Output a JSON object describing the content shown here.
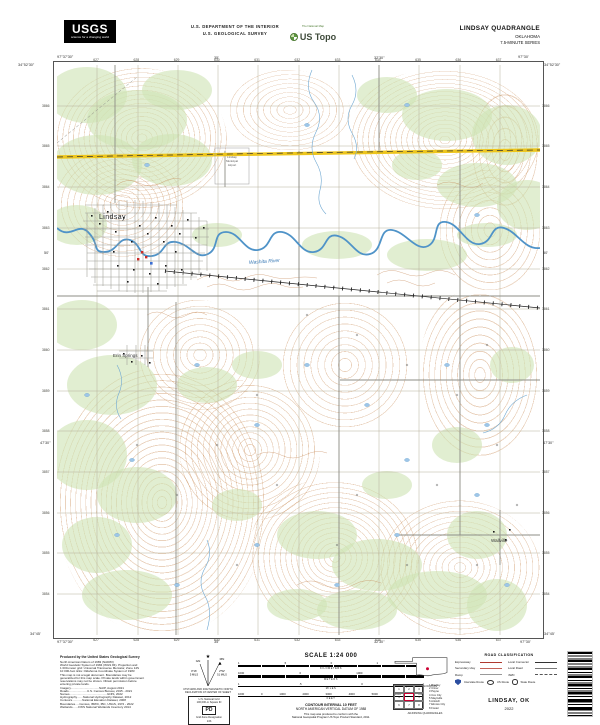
{
  "header": {
    "usgs_word": "USGS",
    "usgs_tagline": "science for a changing world",
    "dept_line1": "U.S. DEPARTMENT OF THE INTERIOR",
    "dept_line2": "U.S. GEOLOGICAL SURVEY",
    "tnm_tagline": "The National Map",
    "ustopo_name": "US Topo",
    "quad_title": "LINDSAY QUADRANGLE",
    "state": "OKLAHOMA",
    "series": "7.5-MINUTE SERIES"
  },
  "map": {
    "labels": {
      "town": "Lindsay",
      "village": "Erin Springs",
      "hamlet": "Wallville",
      "river": "Washita River",
      "airport1": "Lindsay",
      "airport2": "Municipal",
      "airport3": "Airport"
    },
    "corners": {
      "tl_lon": "97°37'30\"",
      "tl_lat": "34°52'30\"",
      "tr_lon": "97°30'",
      "tr_lat": "34°52'30\"",
      "bl_lon": "97°37'30\"",
      "bl_lat": "34°45'",
      "br_lon": "97°30'",
      "br_lat": "34°45'"
    },
    "graticule": {
      "top_a": "35'",
      "top_b": "32'30\"",
      "bottom_a": "35'",
      "bottom_b": "32'30\"",
      "left_a": "50'",
      "left_b": "47'30\"",
      "right_a": "50'",
      "right_b": "47'30\""
    },
    "top_ticks": [
      "627",
      "628",
      "629",
      "630",
      "631",
      "632",
      "633",
      "634",
      "635",
      "636",
      "637"
    ],
    "bottom_ticks": [
      "627",
      "628",
      "629",
      "630",
      "631",
      "632",
      "633",
      "634",
      "635",
      "636",
      "637"
    ],
    "left_ticks": [
      "3866",
      "3865",
      "3864",
      "3863",
      "3862",
      "3861",
      "3860",
      "3859",
      "3858",
      "3857",
      "3856",
      "3855",
      "3854"
    ],
    "right_ticks": [
      "3866",
      "3865",
      "3864",
      "3863",
      "3862",
      "3861",
      "3860",
      "3859",
      "3858",
      "3857",
      "3856",
      "3855",
      "3854"
    ],
    "colors": {
      "woods": "#cfe3b4",
      "contour": "#c07a45",
      "water": "#4f93c8",
      "highway": "#edc51c",
      "paper": "#fdfcf1",
      "building_red": "#cc2b27",
      "building_blue": "#3b6fd4"
    }
  },
  "footer": {
    "credits_title": "Produced by the United States Geological Survey",
    "credits_lines": [
      "North American Datum of 1983 (NAD83)",
      "World Geodetic System of 1984 (WGS 84). Projection and",
      "1 000-meter grid: Universal Transverse Mercator, Zone 14S",
      "10 000-foot ticks: Oklahoma Coordinate System of 1983",
      "This map is not a legal document. Boundaries may be",
      "generalized for this map scale. Private lands within government",
      "reservations may not be shown. Obtain permission before",
      "entering private lands.",
      "Imagery..................................NAIP, August 2021",
      "Roads......................U.S. Census Bureau, 2015 - 2021",
      "Names.............................................GNIS, 2022",
      "Hydrography.......National Hydrography Dataset, 2012",
      "Contours............National Elevation Dataset, 2008",
      "Boundaries.....Census, IBWC, IBC, USGS, 1972 - 2022",
      "Wetlands.......FWS National Wetlands Inventory 2014"
    ],
    "declination": {
      "star": "★",
      "gn_label": "GN",
      "mn_label": "MN",
      "gn_deg": "0°16'",
      "gn_mils": "5 MILS",
      "mn_deg": "2°52'",
      "mn_mils": "51 MILS",
      "caption1": "UTM GRID AND 2022 MAGNETIC NORTH",
      "caption2": "DECLINATION AT CENTER OF SHEET"
    },
    "usng": {
      "title": "U.S. National Grid",
      "sq_label": "100,000-m Square ID",
      "square": "PD",
      "zone_label": "Grid Zone Designation",
      "zone": "14S"
    },
    "scale": {
      "title": "SCALE 1:24 000",
      "km_ticks": [
        "1",
        ".5",
        "0",
        "1",
        "2"
      ],
      "km_unit": "KILOMETERS",
      "m_ticks": [
        "1000",
        "0",
        "1000",
        "2000"
      ],
      "m_unit": "METERS",
      "mi_ticks": [
        "1",
        ".5",
        "0",
        "1"
      ],
      "mi_unit": "MILES",
      "ft_ticks": [
        "1000",
        "0",
        "1000",
        "2000",
        "3000",
        "4000",
        "5000",
        "6000",
        "7000"
      ],
      "ft_unit": "FEET",
      "contour": "CONTOUR INTERVAL 10 FEET",
      "datum": "NORTH AMERICAN VERTICAL DATUM OF 1988",
      "conform1": "This map was produced to conform with the",
      "conform2": "National Geospatial Program US Topo Product Standard, 2011."
    },
    "location": {
      "caption": "QUADRANGLE LOCATION"
    },
    "adjoining": {
      "caption": "ADJOINING QUADRANGLES",
      "cells": [
        "1",
        "2",
        "3",
        "4",
        "",
        "5",
        "6",
        "7",
        "8"
      ],
      "names": [
        "Bradley",
        "Criner",
        "Payne",
        "Cox City",
        "Maysville",
        "Antioch",
        "Elmore City",
        "Foster"
      ]
    },
    "roadclass": {
      "title": "ROAD CLASSIFICATION",
      "left": [
        "Expressway",
        "Secondary Hwy",
        "Ramp"
      ],
      "right": [
        "Local Connector",
        "Local Road",
        "4WD"
      ],
      "shields": [
        "Interstate Route",
        "US Route",
        "State Route"
      ]
    },
    "imprint": {
      "name": "LINDSAY, OK",
      "year": "2022"
    }
  }
}
